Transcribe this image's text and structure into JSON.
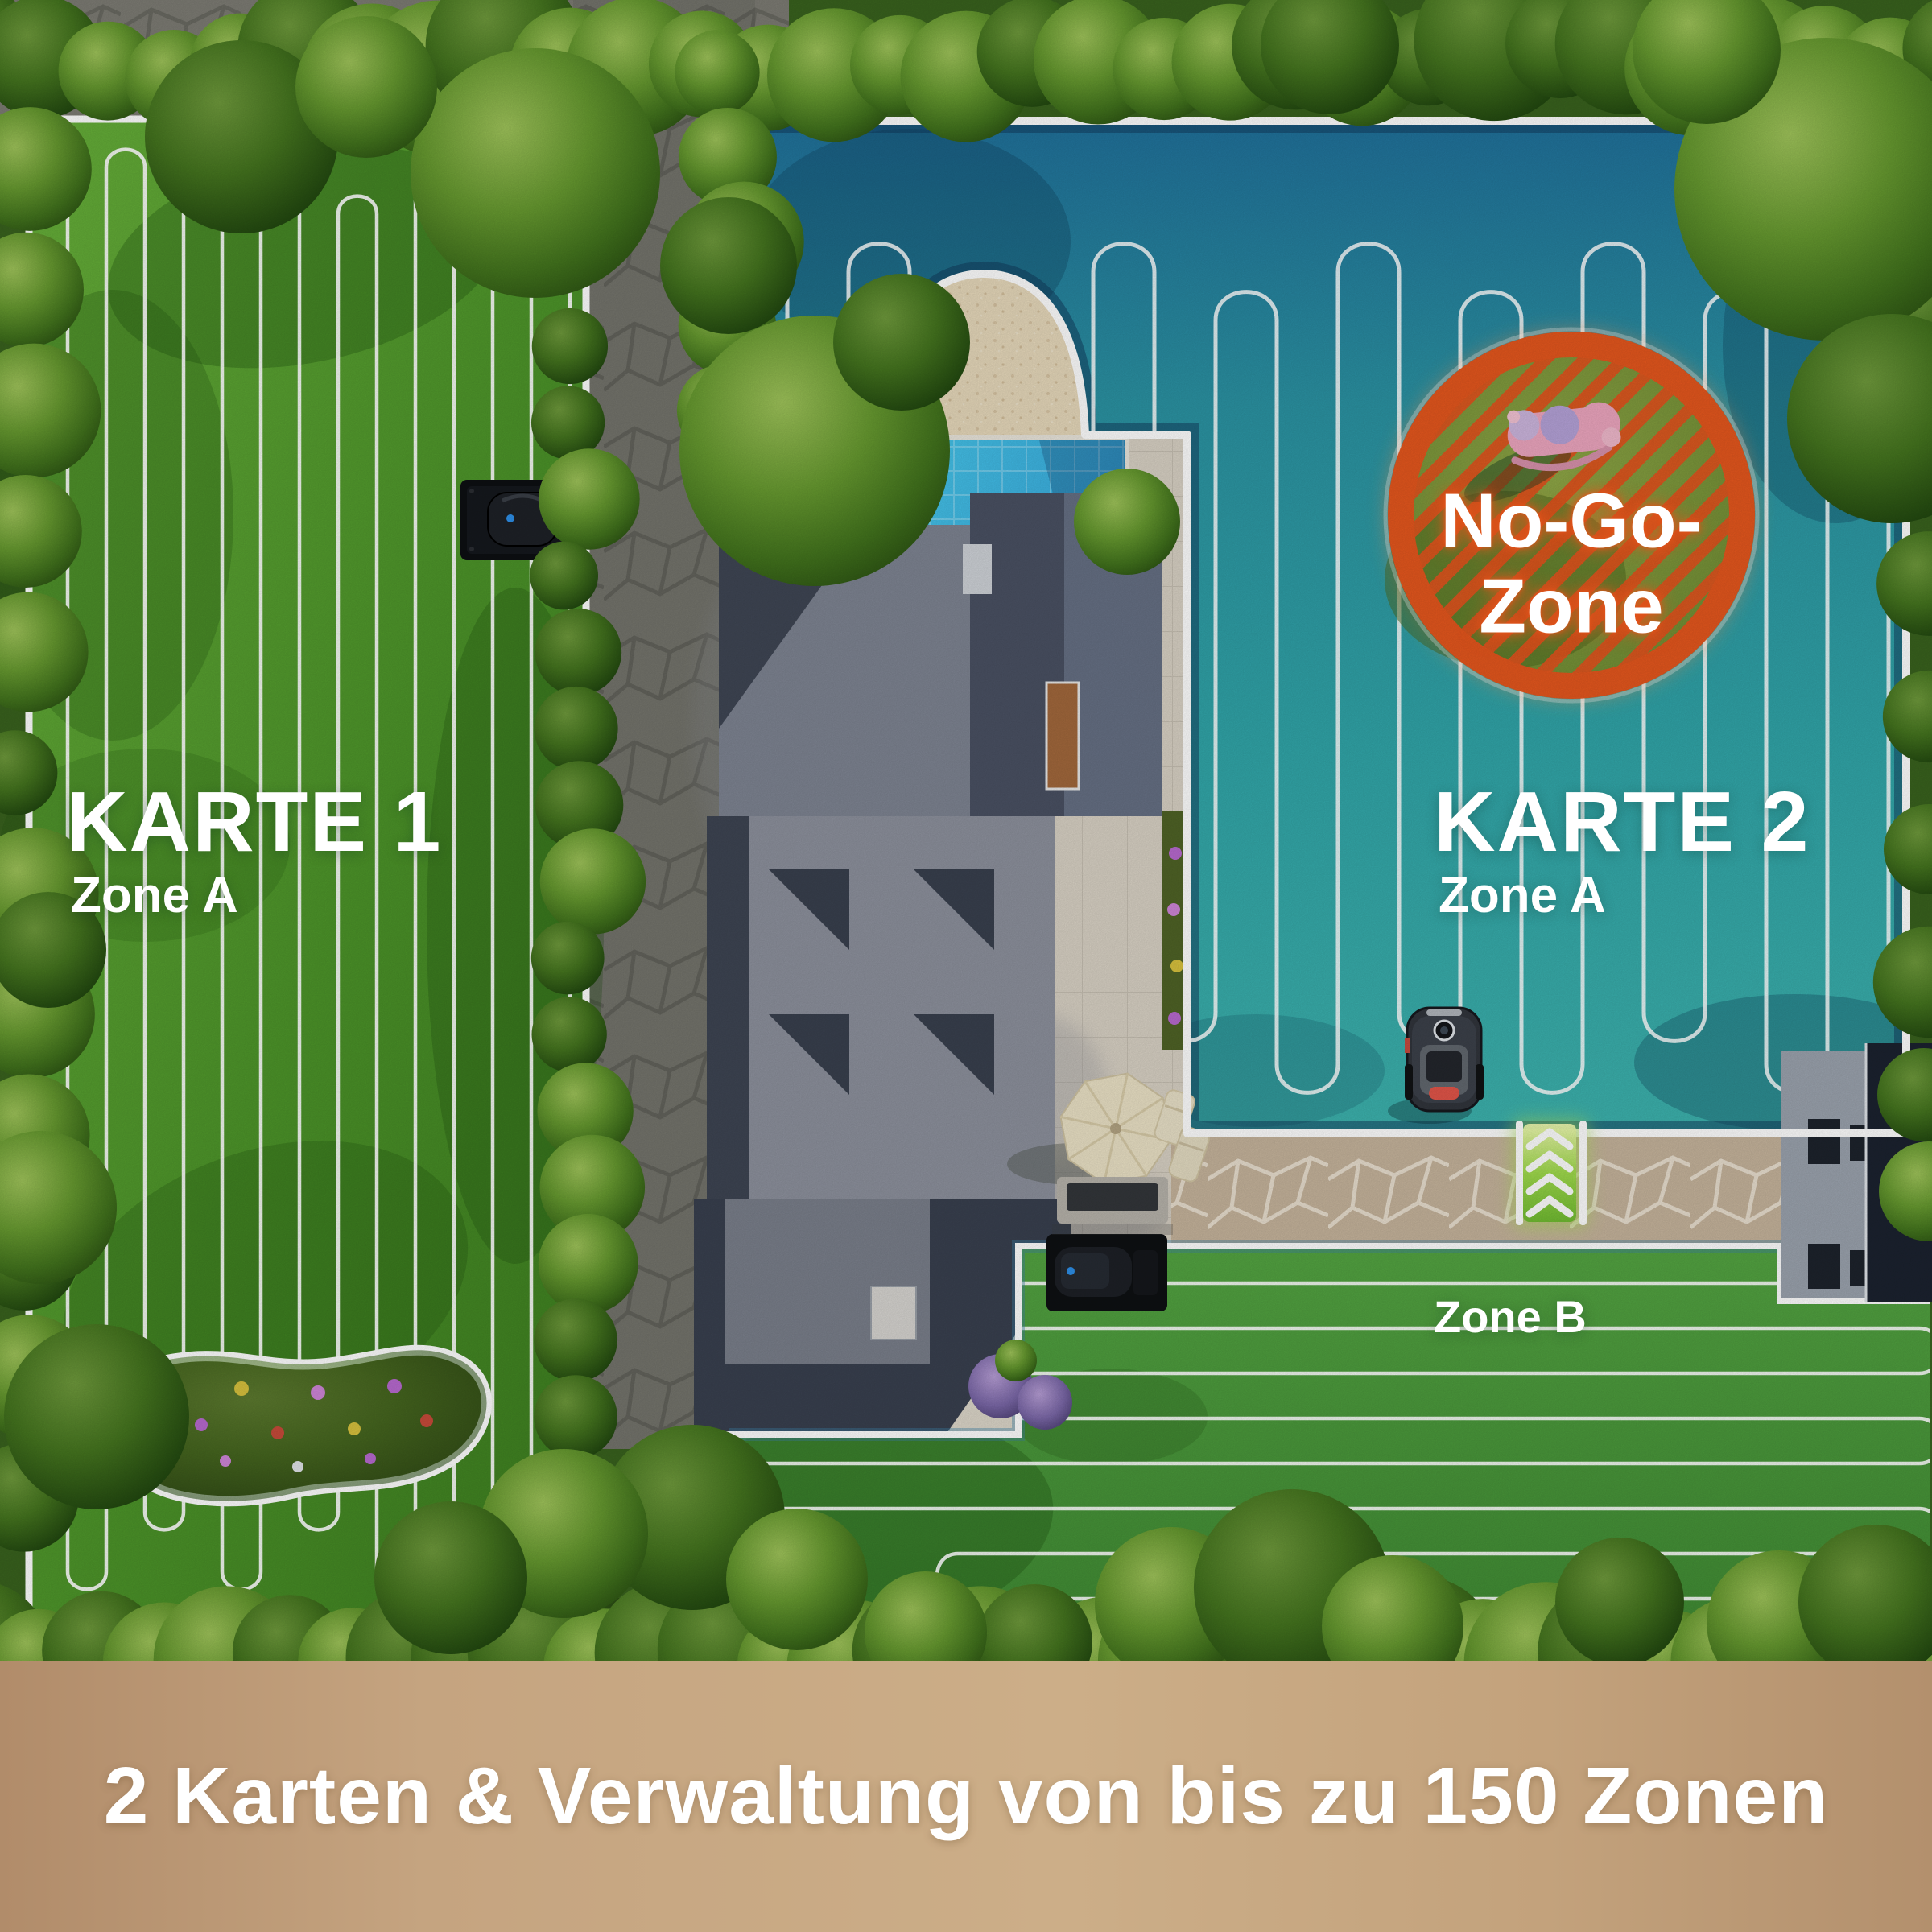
{
  "image_type": "robot-mower-multi-map-feature-illustration",
  "maps": {
    "map1": {
      "title": "KARTE 1",
      "zone_label": "Zone A"
    },
    "map2": {
      "title": "KARTE 2",
      "zone_a_label": "Zone A",
      "zone_b_label": "Zone B"
    },
    "no_go_zone": {
      "label_line1": "No-Go-",
      "label_line2": "Zone"
    }
  },
  "caption": {
    "text": "2 Karten & Verwaltung von bis zu 150 Zonen"
  },
  "colors": {
    "map1_lawn_green": "#4f9a2b",
    "map2_overlay_teal": "#2e9aa4",
    "map2_deep_blue": "#20719b",
    "zone_b_green": "#4a9a3d",
    "no_go_orange": "#e5571e",
    "boundary_white": "#ffffff",
    "pool_blue": "#39b7e2",
    "sand_beige": "#e7d9bb",
    "patio_gray": "#d9d2c5",
    "roof_dark_gray": "#454c5b",
    "footer_tan": "#c2a27e",
    "chevron_green": "#8fd24a",
    "text_white": "#ffffff"
  },
  "icons": {
    "robot_mower": "robot-mower-icon",
    "charging_dock_map1": "charging-dock-icon",
    "charging_dock_zone_b": "charging-dock-icon",
    "no_go_toy": "rocking-horse-toy-icon",
    "zone_transfer": "chevron-up-arrows-icon",
    "boundary_marker": "boundary-dot-icon"
  }
}
